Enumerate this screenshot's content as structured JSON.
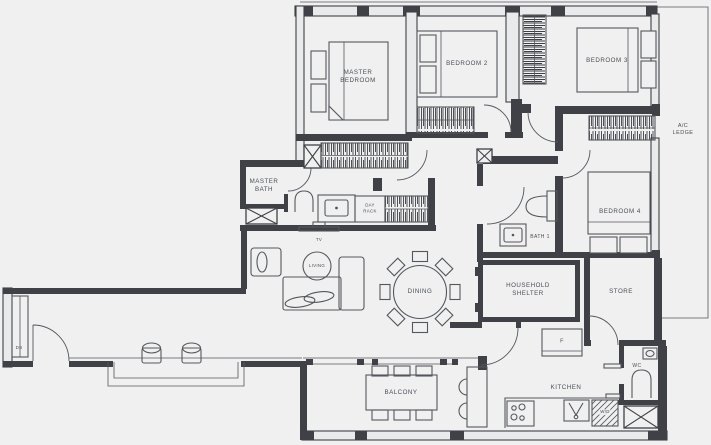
{
  "colors": {
    "background": "#f0f0f1",
    "wall": "#3f4146",
    "line": "#54575c",
    "text": "#4a4e54"
  },
  "labels": {
    "master_bedroom": "MASTER\nBEDROOM",
    "bedroom2": "BEDROOM 2",
    "bedroom3": "BEDROOM 3",
    "bedroom4": "BEDROOM 4",
    "master_bath": "MASTER\nBATH",
    "day_rack": "DAY\nRACK",
    "bath1": "BATH 1",
    "household_shelter": "HOUSEHOLD\nSHELTER",
    "store": "STORE",
    "living": "LIVING",
    "dining": "DINING",
    "kitchen": "KITCHEN",
    "balcony": "BALCONY",
    "wc": "WC",
    "fridge": "F",
    "washer_dryer": "W/D",
    "tv": "TV",
    "db": "DB",
    "ac_ledge": "A/C LEDGE"
  }
}
